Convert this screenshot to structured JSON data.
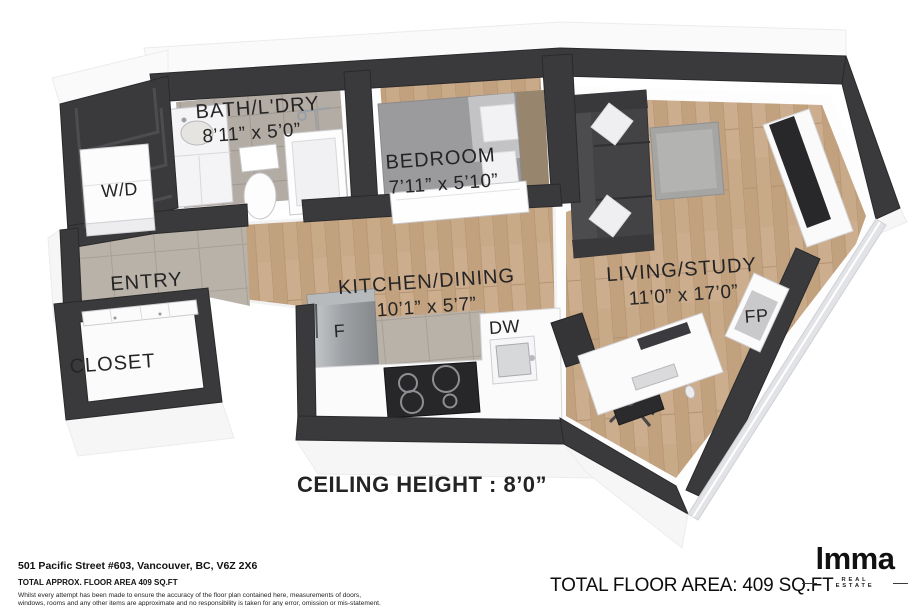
{
  "plan": {
    "rooms": {
      "bath": {
        "label": "BATH/L'DRY",
        "dims": "8’11” x 5’0”"
      },
      "wd": {
        "label": "W/D"
      },
      "bedroom": {
        "label": "BEDROOM",
        "dims": "7’11” x 5’10”"
      },
      "entry": {
        "label": "ENTRY"
      },
      "kitchen": {
        "label": "KITCHEN/DINING",
        "dims": "10’1” x 5’7”"
      },
      "living": {
        "label": "LIVING/STUDY",
        "dims": "11’0” x 17’0”"
      },
      "closet": {
        "label": "CLOSET"
      }
    },
    "appliances": {
      "fridge": {
        "label": "F"
      },
      "dishwasher": {
        "label": "DW"
      },
      "fireplace": {
        "label": "FP"
      }
    },
    "ceiling_note": "CEILING HEIGHT : 8’0”"
  },
  "footer": {
    "address": "501 Pacific Street #603, Vancouver, BC, V6Z 2X6",
    "approx_area": "TOTAL APPROX. FLOOR AREA 409 SQ.FT",
    "disclaimer_line1": "Whilst every attempt has been made to ensure the accuracy of the floor plan contained here, measurements of doors,",
    "disclaimer_line2": "windows, rooms and any other items are approximate and no responsibility is taken for any error, omission or mis-statement.",
    "total_area": "TOTAL FLOOR AREA: 409 SQ.FT"
  },
  "brand": {
    "logo_text": "lmma",
    "logo_tagline": "REAL ESTATE"
  },
  "colors": {
    "wall": "#3a3a3c",
    "wood_floor": "#c8a988",
    "tile_floor": "#b3aca4",
    "text": "#242425",
    "background": "#ffffff"
  }
}
